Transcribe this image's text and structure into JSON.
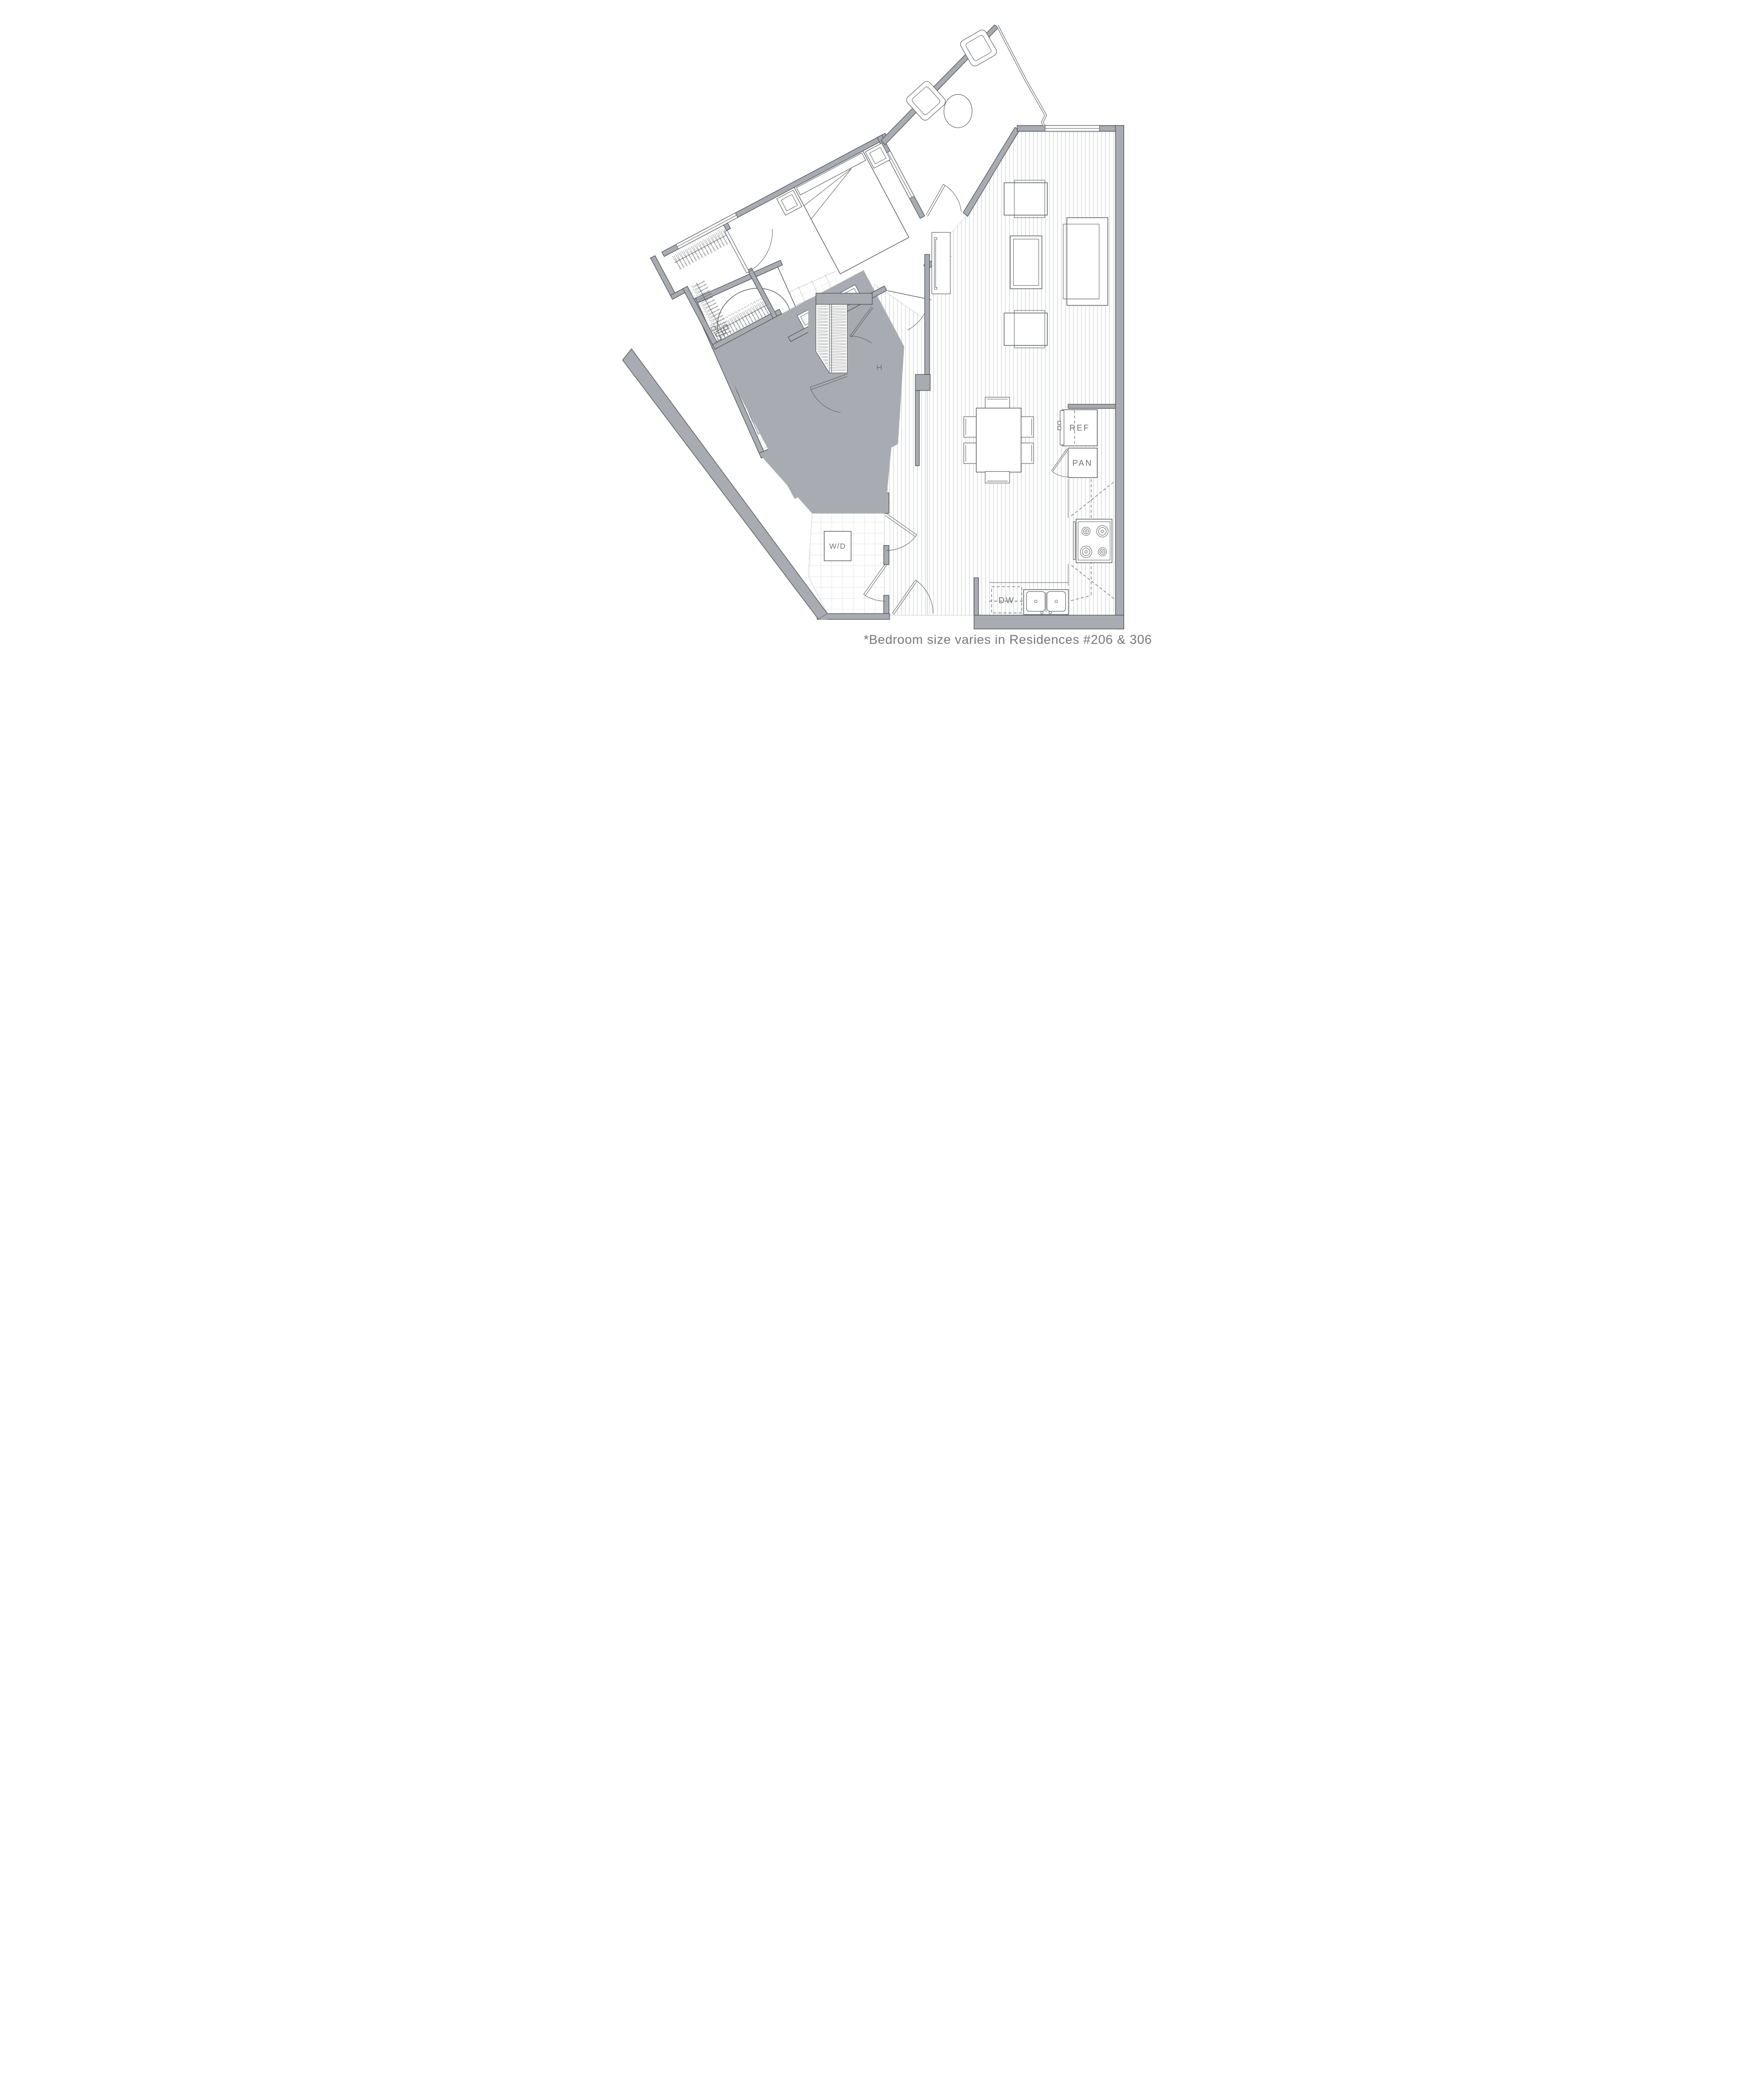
{
  "footnote": "*Bedroom size varies in Residences #206 & 306",
  "labels": {
    "refrigerator": "REF",
    "pantry": "PAN",
    "dishwasher": "DW",
    "washer_dryer": "W/D"
  },
  "colors": {
    "wall": "#a8acb2",
    "line": "#55575a",
    "label_text": "#6f7174",
    "footnote_text": "#77787b",
    "wood_stripe": "#dcdddf",
    "tile_dark": "#9ea1a5",
    "tile_light": "#d3d4d6",
    "background": "#ffffff"
  }
}
